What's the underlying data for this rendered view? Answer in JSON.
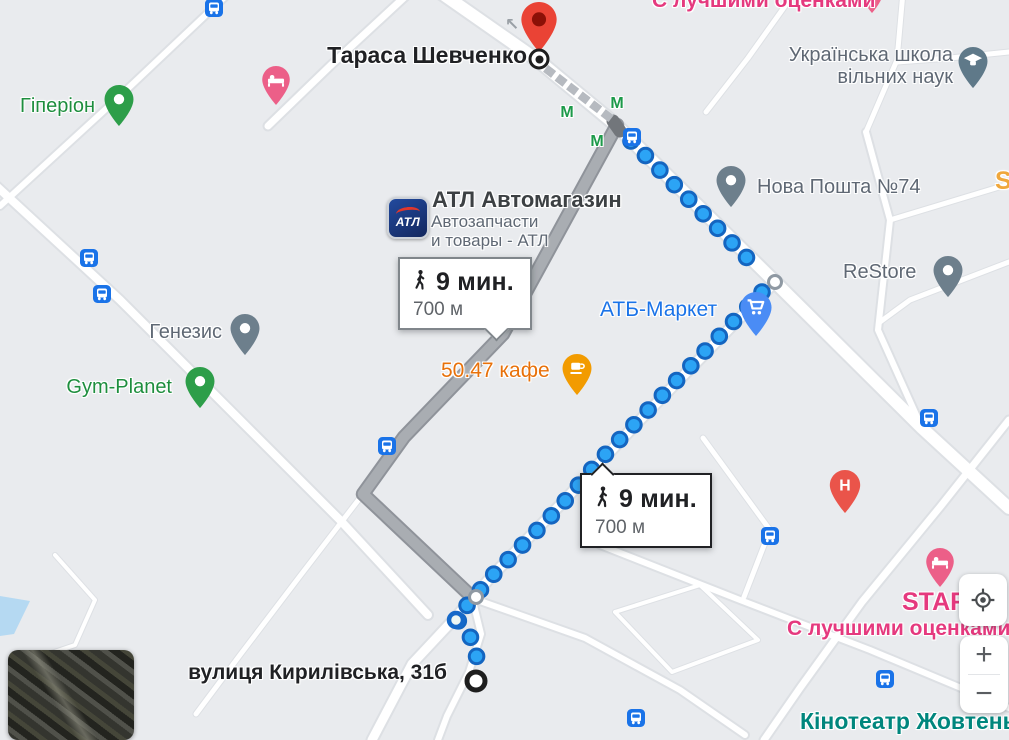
{
  "map": {
    "colors": {
      "background": "#e9ebee",
      "road_fill": "#ffffff",
      "road_casing": "#dde0e4",
      "gray_route_fill": "#a9adb2",
      "gray_route_casing": "#8f939a",
      "blue_dot_fill": "#2ca4f5",
      "blue_dot_ring": "#1465c0",
      "walk_dash": "#b6bac0",
      "water": "#b5d9f2"
    },
    "roads": [
      {
        "w": 12,
        "pts": [
          [
            437,
            -10
          ],
          [
            540,
            62
          ],
          [
            616,
            125
          ],
          [
            775,
            282
          ],
          [
            922,
            428
          ],
          [
            1009,
            508
          ]
        ]
      },
      {
        "w": 7,
        "pts": [
          [
            410,
            -8
          ],
          [
            330,
            66
          ],
          [
            268,
            126
          ]
        ]
      },
      {
        "w": 6,
        "pts": [
          [
            230,
            -8
          ],
          [
            120,
            96
          ],
          [
            0,
            206
          ]
        ]
      },
      {
        "w": 9,
        "pts": [
          [
            616,
            125
          ],
          [
            503,
            334
          ],
          [
            404,
            437
          ],
          [
            363,
            494
          ]
        ]
      },
      {
        "w": 5,
        "pts": [
          [
            363,
            494
          ],
          [
            300,
            576
          ],
          [
            240,
            655
          ],
          [
            196,
            714
          ]
        ]
      },
      {
        "w": 8,
        "pts": [
          [
            363,
            494
          ],
          [
            472,
            597
          ]
        ]
      },
      {
        "w": 6,
        "pts": [
          [
            472,
            597
          ],
          [
            481,
            634
          ],
          [
            469,
            672
          ],
          [
            447,
            716
          ],
          [
            438,
            740
          ]
        ]
      },
      {
        "w": 9,
        "pts": [
          [
            775,
            282
          ],
          [
            640,
            420
          ],
          [
            560,
            505
          ],
          [
            490,
            578
          ],
          [
            455,
            618
          ],
          [
            412,
            664
          ],
          [
            372,
            740
          ]
        ]
      },
      {
        "w": 6,
        "pts": [
          [
            480,
            601
          ],
          [
            585,
            638
          ],
          [
            680,
            690
          ],
          [
            745,
            735
          ]
        ]
      },
      {
        "w": 8,
        "pts": [
          [
            -8,
            182
          ],
          [
            120,
            300
          ],
          [
            240,
            420
          ],
          [
            340,
            520
          ],
          [
            428,
            615
          ]
        ]
      },
      {
        "w": 5,
        "pts": [
          [
            903,
            -8
          ],
          [
            897,
            60
          ],
          [
            866,
            132
          ]
        ]
      },
      {
        "w": 5,
        "pts": [
          [
            897,
            62
          ],
          [
            950,
            58
          ],
          [
            1009,
            52
          ]
        ]
      },
      {
        "w": 5,
        "pts": [
          [
            795,
            -8
          ],
          [
            748,
            58
          ],
          [
            706,
            112
          ]
        ]
      },
      {
        "w": 6,
        "pts": [
          [
            866,
            132
          ],
          [
            890,
            220
          ],
          [
            878,
            330
          ],
          [
            922,
            428
          ]
        ]
      },
      {
        "w": 5,
        "pts": [
          [
            890,
            220
          ],
          [
            1009,
            184
          ]
        ]
      },
      {
        "w": 5,
        "pts": [
          [
            1009,
            262
          ],
          [
            910,
            300
          ],
          [
            880,
            322
          ]
        ]
      },
      {
        "w": 7,
        "pts": [
          [
            1009,
            420
          ],
          [
            940,
            507
          ],
          [
            862,
            602
          ],
          [
            800,
            688
          ],
          [
            764,
            740
          ]
        ]
      },
      {
        "w": 6,
        "pts": [
          [
            600,
            545
          ],
          [
            740,
            600
          ],
          [
            870,
            650
          ],
          [
            1009,
            708
          ]
        ]
      },
      {
        "w": 5,
        "pts": [
          [
            703,
            438
          ],
          [
            770,
            530
          ],
          [
            744,
            597
          ]
        ]
      },
      {
        "w": 4,
        "pts": [
          [
            55,
            555
          ],
          [
            95,
            600
          ],
          [
            75,
            645
          ],
          [
            25,
            662
          ]
        ]
      },
      {
        "w": 4,
        "pts": [
          [
            615,
            612
          ],
          [
            700,
            585
          ],
          [
            758,
            640
          ],
          [
            672,
            672
          ],
          [
            615,
            612
          ]
        ]
      }
    ],
    "water_polygon": [
      [
        0,
        596
      ],
      [
        30,
        601
      ],
      [
        14,
        634
      ],
      [
        0,
        636
      ]
    ],
    "walk_dash_path": [
      [
        549,
        71
      ],
      [
        609,
        117
      ]
    ],
    "gray_route": {
      "points": [
        [
          617,
          125
        ],
        [
          503,
          334
        ],
        [
          404,
          437
        ],
        [
          363,
          494
        ],
        [
          472,
          597
        ]
      ],
      "start_cap": [
        [
          613,
          121
        ],
        [
          620,
          131
        ]
      ]
    },
    "blue_route": {
      "dot_spacing": 20.5,
      "upper": [
        [
          631,
          141
        ],
        [
          755,
          266
        ]
      ],
      "lower": [
        [
          762,
          292
        ],
        [
          598,
          462
        ],
        [
          560,
          507
        ],
        [
          492,
          576
        ],
        [
          477,
          594
        ],
        [
          456,
          618
        ],
        [
          469,
          634
        ],
        [
          477,
          652
        ],
        [
          475,
          672
        ]
      ]
    },
    "waypoints": [
      [
        775,
        282
      ],
      [
        476,
        597
      ]
    ],
    "transit_stop": {
      "x": 456,
      "y": 620
    },
    "origin": {
      "x": 476,
      "y": 681
    },
    "destination": {
      "pin_x": 539,
      "pin_tip_y": 57,
      "circle_x": 539,
      "circle_y": 59
    },
    "labels": [
      {
        "id": "taras-shevchenko",
        "lines": [
          "Тараса Шевченко"
        ],
        "x": 527,
        "y": 43,
        "align": "right",
        "size": 23,
        "weight": 500,
        "color": "#202124"
      },
      {
        "id": "school",
        "lines": [
          "Українська школа",
          "вільних наук"
        ],
        "x": 953,
        "y": 44,
        "align": "right",
        "size": 20,
        "weight": 400,
        "color": "#5f6874"
      },
      {
        "id": "nova-poshta",
        "lines": [
          "Нова Пошта №74"
        ],
        "x": 757,
        "y": 176,
        "align": "left",
        "size": 20,
        "weight": 400,
        "color": "#5f6874"
      },
      {
        "id": "restore",
        "lines": [
          "ReStore"
        ],
        "x": 843,
        "y": 261,
        "align": "left",
        "size": 20,
        "weight": 400,
        "color": "#5f6874"
      },
      {
        "id": "s-partial",
        "lines": [
          "S"
        ],
        "x": 995,
        "y": 167,
        "align": "left",
        "size": 25,
        "weight": 700,
        "color": "#f0a73b"
      },
      {
        "id": "atl-title",
        "lines": [
          "АТЛ Автомагазин"
        ],
        "x": 432,
        "y": 188,
        "align": "left",
        "size": 22,
        "weight": 500,
        "color": "#3c4043"
      },
      {
        "id": "atl-sub",
        "lines": [
          "Автозапчасти",
          "и товары - АТЛ"
        ],
        "x": 431,
        "y": 212,
        "align": "left",
        "size": 17,
        "weight": 400,
        "color": "#5f6874"
      },
      {
        "id": "atb-market",
        "lines": [
          "АТБ-Маркет"
        ],
        "x": 600,
        "y": 298,
        "align": "left",
        "size": 21,
        "weight": 400,
        "color": "#1a73e8"
      },
      {
        "id": "cafe-5047",
        "lines": [
          "50.47 кафе"
        ],
        "x": 441,
        "y": 359,
        "align": "left",
        "size": 21,
        "weight": 400,
        "color": "#e8710a"
      },
      {
        "id": "genezis",
        "lines": [
          "Генезис"
        ],
        "x": 222,
        "y": 321,
        "align": "right",
        "size": 20,
        "weight": 400,
        "color": "#5f6874"
      },
      {
        "id": "gym-planet",
        "lines": [
          "Gym-Planet"
        ],
        "x": 172,
        "y": 376,
        "align": "right",
        "size": 20,
        "weight": 400,
        "color": "#1e8e3e"
      },
      {
        "id": "hyperion",
        "lines": [
          "Гіперіон"
        ],
        "x": 95,
        "y": 95,
        "align": "right",
        "size": 20,
        "weight": 400,
        "color": "#1e8e3e"
      },
      {
        "id": "kyrylivska",
        "lines": [
          "вулиця Кирилівська, 31б"
        ],
        "x": 447,
        "y": 661,
        "align": "right",
        "size": 21,
        "weight": 500,
        "color": "#202124"
      },
      {
        "id": "star",
        "lines": [
          "STAR"
        ],
        "x": 902,
        "y": 588,
        "align": "left",
        "size": 25,
        "weight": 700,
        "color": "#e5397e"
      },
      {
        "id": "best-rated-top",
        "lines": [
          "С лучшими оценками"
        ],
        "x": 652,
        "y": -11,
        "align": "left",
        "size": 21,
        "weight": 500,
        "color": "#e5397e"
      },
      {
        "id": "best-rated-bottom",
        "lines": [
          "С лучшими оценками"
        ],
        "x": 787,
        "y": 617,
        "align": "left",
        "size": 21,
        "weight": 500,
        "color": "#e5397e"
      },
      {
        "id": "kinoteatr",
        "lines": [
          "Кінотеатр Жовтень"
        ],
        "x": 800,
        "y": 709,
        "align": "left",
        "size": 23,
        "weight": 500,
        "color": "#00867d"
      }
    ],
    "pins": [
      {
        "id": "destination",
        "x": 539,
        "tip": 57,
        "color": "#ea4335",
        "glyph": "inner-circle",
        "scale": 1.35
      },
      {
        "id": "hyperion",
        "x": 119,
        "tip": 131,
        "color": "#2d9e49",
        "glyph": "dot",
        "scale": 1.1
      },
      {
        "id": "hotel-top-left",
        "x": 276,
        "tip": 110,
        "color": "#ec5f88",
        "glyph": "bed",
        "scale": 1.05
      },
      {
        "id": "school",
        "x": 973,
        "tip": 93,
        "color": "#5f7989",
        "glyph": "grad",
        "scale": 1.1
      },
      {
        "id": "nova-poshta",
        "x": 731,
        "tip": 212,
        "color": "#6d7f8c",
        "glyph": "dot",
        "scale": 1.1
      },
      {
        "id": "restore",
        "x": 948,
        "tip": 302,
        "color": "#6d7f8c",
        "glyph": "dot",
        "scale": 1.1
      },
      {
        "id": "atb-market",
        "x": 756,
        "tip": 341,
        "color": "#4a8cf5",
        "glyph": "cart",
        "scale": 1.2
      },
      {
        "id": "cafe",
        "x": 577,
        "tip": 400,
        "color": "#f29b00",
        "glyph": "cup",
        "scale": 1.1
      },
      {
        "id": "genezis",
        "x": 245,
        "tip": 360,
        "color": "#6d7f8c",
        "glyph": "dot",
        "scale": 1.1
      },
      {
        "id": "gym-planet",
        "x": 200,
        "tip": 413,
        "color": "#2d9e49",
        "glyph": "dot",
        "scale": 1.1
      },
      {
        "id": "hospital",
        "x": 845,
        "tip": 518,
        "color": "#ea544a",
        "glyph": "H",
        "scale": 1.15
      },
      {
        "id": "hotel-star",
        "x": 940,
        "tip": 592,
        "color": "#ec5f88",
        "glyph": "bed",
        "scale": 1.05
      },
      {
        "id": "pin-top-right",
        "x": 872,
        "tip": 18,
        "color": "#ec5f88",
        "glyph": "dot",
        "scale": 0.8
      }
    ],
    "bus_stops": [
      {
        "x": 214,
        "y": 8
      },
      {
        "x": 89,
        "y": 258
      },
      {
        "x": 102,
        "y": 294
      },
      {
        "x": 632,
        "y": 137
      },
      {
        "x": 387,
        "y": 446
      },
      {
        "x": 770,
        "y": 536
      },
      {
        "x": 929,
        "y": 418
      },
      {
        "x": 885,
        "y": 679
      },
      {
        "x": 636,
        "y": 718
      }
    ],
    "metro": {
      "glyph": "М",
      "positions": [
        [
          567,
          113
        ],
        [
          617,
          104
        ],
        [
          597,
          142
        ]
      ]
    },
    "oneway_arrow": {
      "glyph": "↖",
      "x": 512,
      "y": 25
    }
  },
  "tooltips": {
    "alt": {
      "time": "9 мин.",
      "distance": "700 м",
      "x": 398,
      "y": 257,
      "w": 132,
      "h": 70,
      "pointer_left": 88
    },
    "selected": {
      "time": "9 мин.",
      "distance": "700 м",
      "x": 580,
      "y": 473,
      "w": 130,
      "h": 73,
      "pointer_left": 12
    }
  },
  "atl_logo": {
    "text": "АТЛ",
    "x": 387,
    "y": 197
  },
  "street_view": {
    "x": 8,
    "y": 650,
    "w": 126,
    "h": 90
  },
  "controls": {
    "my_location": {
      "x": 959,
      "y": 574,
      "w": 48,
      "h": 52
    },
    "zoom": {
      "x": 960,
      "y": 636,
      "w": 48,
      "h": 77,
      "zoom_in": "+",
      "zoom_out": "−"
    }
  }
}
